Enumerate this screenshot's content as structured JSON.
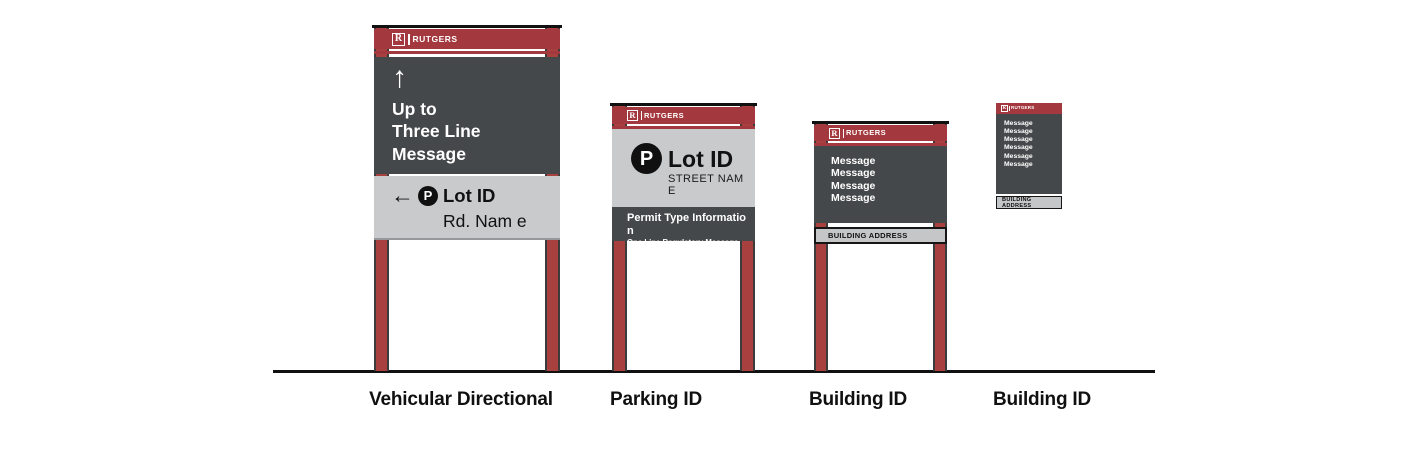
{
  "brand": {
    "block_r": "R",
    "wordmark": "RUTGERS"
  },
  "signs": {
    "vehicular_directional": {
      "label": "Vehicular Directional",
      "up_arrow": "↑",
      "message_lines": [
        "Up to",
        "Three Line",
        "Message"
      ],
      "left_arrow": "←",
      "parking_symbol": "P",
      "lot_id": "Lot ID",
      "road_name": "Rd. Nam e"
    },
    "parking_id": {
      "label": "Parking ID",
      "parking_symbol": "P",
      "lot_id": "Lot ID",
      "street_name": "STREET NAM E",
      "permit_info": "Permit Type Informatio n",
      "regulatory": "One Line Regulatory Message"
    },
    "building_id_large": {
      "label": "Building ID",
      "messages": [
        "Message",
        "Message",
        "Message",
        "Message"
      ],
      "address": "BUILDING ADDRESS"
    },
    "building_id_small": {
      "label": "Building ID",
      "messages": [
        "Message",
        "Message",
        "Message",
        "Message",
        "Message",
        "Message"
      ],
      "address": "BUILDING ADDRESS"
    }
  },
  "colors": {
    "scarlet": "#A3383E",
    "post_red": "#A84040",
    "dark_panel": "#44484A",
    "light_panel": "#C9CACC",
    "address_bg": "#C5C6C8",
    "ink": "#111111"
  }
}
